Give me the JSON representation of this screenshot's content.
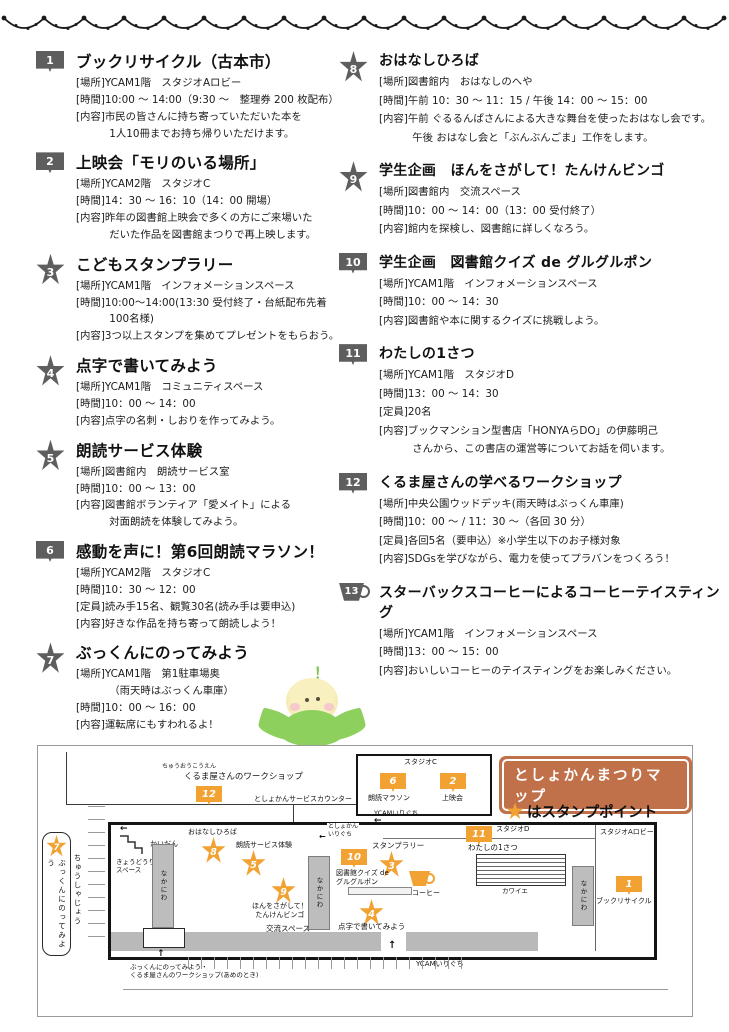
{
  "events": [
    {
      "num": "1",
      "shape": "book",
      "title": "ブックリサイクル（古本市）",
      "details": [
        {
          "label": "[場所]",
          "text": "YCAM1階　スタジオAロビー"
        },
        {
          "label": "[時間]",
          "text": "10:00 ～ 14:00（9:30 ～　整理券 200 枚配布）"
        },
        {
          "label": "[内容]",
          "text": "市民の皆さんに持ち寄っていただいた本を\n1人10冊までお持ち帰りいただけます。"
        }
      ]
    },
    {
      "num": "2",
      "shape": "book",
      "title": "上映会「モリのいる場所」",
      "details": [
        {
          "label": "[場所]",
          "text": "YCAM2階　スタジオC"
        },
        {
          "label": "[時間]",
          "text": "14：30 ～ 16：10（14：00 開場）"
        },
        {
          "label": "[内容]",
          "text": "昨年の図書館上映会で多くの方にご来場いた\nだいた作品を図書館まつりで再上映します。"
        }
      ]
    },
    {
      "num": "3",
      "shape": "star",
      "title": "こどもスタンプラリー",
      "details": [
        {
          "label": "[場所]",
          "text": "YCAM1階　インフォメーションスペース"
        },
        {
          "label": "[時間]",
          "text": "10:00～14:00(13:30 受付終了・台紙配布先着100名様)"
        },
        {
          "label": "[内容]",
          "text": "3つ以上スタンプを集めてプレゼントをもらおう。"
        }
      ]
    },
    {
      "num": "4",
      "shape": "star",
      "title": "点字で書いてみよう",
      "details": [
        {
          "label": "[場所]",
          "text": "YCAM1階　コミュニティスペース"
        },
        {
          "label": "[時間]",
          "text": "10：00 ～ 14：00"
        },
        {
          "label": "[内容]",
          "text": "点字の名刺・しおりを作ってみよう。"
        }
      ]
    },
    {
      "num": "5",
      "shape": "star",
      "title": "朗読サービス体験",
      "details": [
        {
          "label": "[場所]",
          "text": "図書館内　朗読サービス室"
        },
        {
          "label": "[時間]",
          "text": "10：00 ～ 13：00"
        },
        {
          "label": "[内容]",
          "text": "図書館ボランティア「愛メイト」による\n対面朗読を体験してみよう。"
        }
      ]
    },
    {
      "num": "6",
      "shape": "book",
      "title": "感動を声に！第6回朗読マラソン！",
      "details": [
        {
          "label": "[場所]",
          "text": "YCAM2階　スタジオC"
        },
        {
          "label": "[時間]",
          "text": "10：30 ～ 12：00"
        },
        {
          "label": "[定員]",
          "text": "読み手15名、観覧30名(読み手は要申込)"
        },
        {
          "label": "[内容]",
          "text": "好きな作品を持ち寄って朗読しよう！"
        }
      ]
    },
    {
      "num": "7",
      "shape": "star",
      "title": "ぶっくんにのってみよう",
      "details": [
        {
          "label": "[場所]",
          "text": "YCAM1階　第1駐車場奥\n（雨天時はぶっくん車庫）"
        },
        {
          "label": "[時間]",
          "text": "10：00 ～ 16：00"
        },
        {
          "label": "[内容]",
          "text": "運転席にもすわれるよ！"
        }
      ]
    },
    {
      "num": "8",
      "shape": "star",
      "title": "おはなしひろば",
      "details": [
        {
          "label": "[場所]",
          "text": "図書館内　おはなしのへや"
        },
        {
          "label": "[時間]",
          "text": "午前 10：30 ～ 11：15 / 午後 14：00 ～ 15：00"
        },
        {
          "label": "[内容]",
          "text": "午前 ぐるるんぱさんによる大きな舞台を使ったおはなし会です。\n午後 おはなし会と「ぶんぶんごま」工作をします。"
        }
      ]
    },
    {
      "num": "9",
      "shape": "star",
      "title": "学生企画　ほんをさがして！たんけんビンゴ",
      "details": [
        {
          "label": "[場所]",
          "text": "図書館内　交流スペース"
        },
        {
          "label": "[時間]",
          "text": "10：00 ～ 14：00（13：00 受付終了）"
        },
        {
          "label": "[内容]",
          "text": "館内を探検し、図書館に詳しくなろう。"
        }
      ]
    },
    {
      "num": "10",
      "shape": "book",
      "title": "学生企画　図書館クイズ de グルグルポン",
      "details": [
        {
          "label": "[場所]",
          "text": "YCAM1階　インフォメーションスペース"
        },
        {
          "label": "[時間]",
          "text": "10：00 ～ 14：30"
        },
        {
          "label": "[内容]",
          "text": "図書館や本に関するクイズに挑戦しよう。"
        }
      ]
    },
    {
      "num": "11",
      "shape": "book",
      "title": "わたしの1さつ",
      "details": [
        {
          "label": "[場所]",
          "text": "YCAM1階　スタジオD"
        },
        {
          "label": "[時間]",
          "text": "13：00 ～ 14：30"
        },
        {
          "label": "[定員]",
          "text": "20名"
        },
        {
          "label": "[内容]",
          "text": "ブックマンション型書店「HONYAらDO」の伊藤明己\nさんから、この書店の運営等についてお話を伺います。"
        }
      ]
    },
    {
      "num": "12",
      "shape": "book",
      "title": "くるま屋さんの学べるワークショップ",
      "details": [
        {
          "label": "[場所]",
          "text": "中央公園ウッドデッキ(雨天時はぶっくん車庫)"
        },
        {
          "label": "[時間]",
          "text": "10：00 ～ / 11：30 ～（各回 30 分）"
        },
        {
          "label": "[定員]",
          "text": "各回5名（要申込）※小学生以下のお子様対象"
        },
        {
          "label": "[内容]",
          "text": "SDGsを学びながら、電力を使ってプラバンをつくろう！"
        }
      ]
    },
    {
      "num": "13",
      "shape": "cup",
      "title": "スターバックスコーヒーによるコーヒーテイスティング",
      "details": [
        {
          "label": "[場所]",
          "text": "YCAM1階　インフォメーションスペース"
        },
        {
          "label": "[時間]",
          "text": "13：00 ～ 15：00"
        },
        {
          "label": "[内容]",
          "text": "おいしいコーヒーのテイスティングをお楽しみください。"
        }
      ]
    }
  ],
  "mascot": {
    "exclaim": "！"
  },
  "map": {
    "title": "としょかんまつりマップ",
    "legend_text": "はスタンプポイント",
    "badges": {
      "ws": "12",
      "marathon": "6",
      "eiga": "2",
      "ohanashi": "8",
      "roudoku": "5",
      "quiz": "10",
      "stamp": "3",
      "coffee": "13",
      "bingo": "9",
      "tenji": "4",
      "watashi": "11",
      "recycle": "1",
      "bukkun": "7"
    },
    "labels": {
      "chuo": "ちゅうおうこうえん",
      "ws": "くるま屋さんのワークショップ",
      "counter": "としょかんサービスカウンター",
      "studio_c": "スタジオC",
      "marathon": "朗読マラソン",
      "eiga": "上映会",
      "ycam_in_top": "YCAMいりぐち",
      "toshokan_in": "としょかん\nいりぐち",
      "kaidan": "かいだん",
      "kyodo": "きょうどうりよう\nスペース",
      "ohanashi": "おはなしひろば",
      "roudoku": "朗読サービス体験",
      "nakaniwa": "なかにわ",
      "stamp": "スタンプラリー",
      "quiz": "図書館クイズ de\nグルグルポン",
      "coffee": "コーヒー",
      "bingo": "ほんをさがして！\nたんけんビンゴ",
      "kouryu": "交流スペース",
      "tenji": "点字で書いてみよう",
      "studio_d": "スタジオD",
      "watashi": "わたしの1さつ",
      "kawaie": "カワイエ",
      "studio_a": "スタジオAロビー",
      "recycle": "ブックリサイクル",
      "pill": "ぶっくんにのってみよう",
      "chusha": "ちゅうしゃじょう",
      "rainy": "ぶっくんにのってみよう・\nくるま屋さんのワークショップ(あめのとき)",
      "ycam_in_bottom": "YCAMいりぐち"
    }
  }
}
